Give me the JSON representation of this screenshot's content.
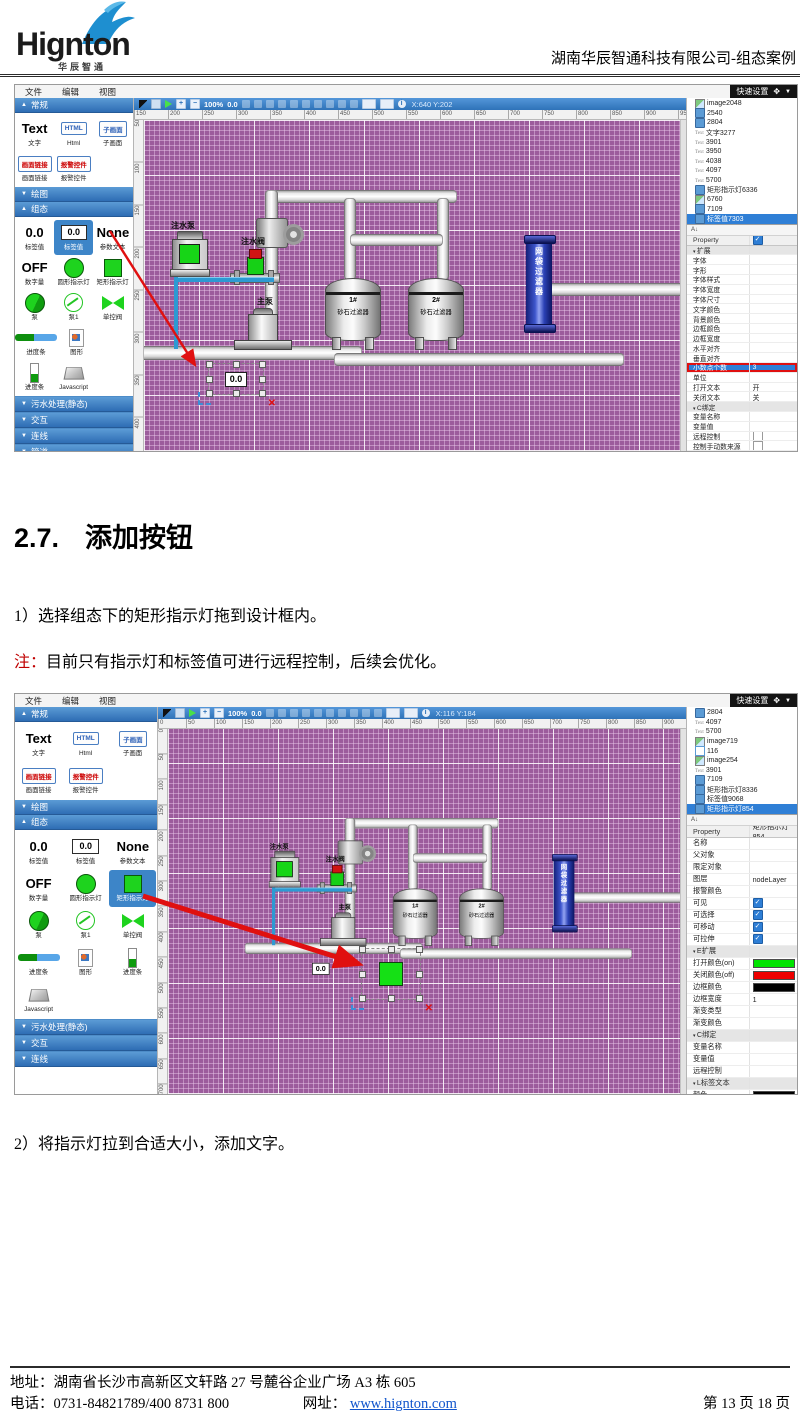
{
  "icons": {
    "move": "✥",
    "caret_down": "▼",
    "close": "✕",
    "sort": "A↓",
    "info": "i",
    "plus": "+",
    "minus": "−"
  },
  "header": {
    "logo_text": "Hignton",
    "logo_sub": "华辰智通",
    "doc_title": "湖南华辰智通科技有限公司-组态案例"
  },
  "doc": {
    "heading_num": "2.7.",
    "heading_text": "添加按钮",
    "step1": "1）选择组态下的矩形指示灯拖到设计框内。",
    "note_label": "注：",
    "note_text": "目前只有指示灯和标签值可进行远程控制，后续会优化。",
    "step2": "2）将指示灯拉到合适大小，添加文字。"
  },
  "footer": {
    "address": "地址：湖南省长沙市高新区文轩路 27 号麓谷企业广场 A3 栋 605",
    "phone": "电话：0731-84821789/400 8731 800",
    "web_label": "网址：",
    "web_url": "www.hignton.com",
    "page_info": "第 13 页 18 页"
  },
  "diagram": {
    "pump1": "注水泵",
    "valve1": "注水阀",
    "pump2": "主泵",
    "tag": "0.0",
    "tank1_no": "1#",
    "tank1_name": "砂石过滤器",
    "tank2_no": "2#",
    "tank2_name": "砂石过滤器",
    "vessel": "网袋过滤器"
  },
  "editor1": {
    "menus": [
      "文件",
      "编辑",
      "视图"
    ],
    "quick_settings": "快速设置",
    "toolbar": {
      "zoom": "100%",
      "angle": "0.0",
      "coords": "X:640 Y:202"
    },
    "sec_common": {
      "label": "常规",
      "arrow": "▲"
    },
    "sec_draw": {
      "label": "绘图",
      "arrow": "▼"
    },
    "sec_zutai": {
      "label": "组态",
      "arrow": "▲"
    },
    "pal_common": [
      {
        "icon": "ic-bigtext",
        "big": "Text",
        "label": "文字"
      },
      {
        "icon": "ic-btn",
        "big": "HTML",
        "label": "Html"
      },
      {
        "icon": "ic-btn",
        "big": "子画面",
        "label": "子画面"
      },
      {
        "icon": "ic-btn red",
        "big": "画面链接",
        "label": "画面链接"
      },
      {
        "icon": "ic-btn red",
        "big": "报警控件",
        "label": "报警控件"
      }
    ],
    "pal_zutai": [
      {
        "icon": "ic-bigtext",
        "big": "0.0",
        "label": "标签值"
      },
      {
        "icon": "ic-box",
        "big": "0.0",
        "label": "标签值",
        "cls": "sel"
      },
      {
        "icon": "ic-bigtext",
        "big": "None",
        "label": "参数文本"
      },
      {
        "icon": "ic-bigtext",
        "big": "OFF",
        "label": "数字量"
      },
      {
        "icon": "ic-circle",
        "label": "圆形指示灯"
      },
      {
        "icon": "ic-square",
        "label": "矩形指示灯"
      },
      {
        "icon": "ic-pie",
        "label": "泵"
      },
      {
        "icon": "ic-ocircle",
        "label": "泵1"
      },
      {
        "icon": "ic-bowtie",
        "label": "单控阀"
      },
      {
        "icon": "ic-hbar",
        "label": "进度条"
      },
      {
        "icon": "ic-file",
        "label": "图形"
      },
      {
        "icon": "ic-vbar",
        "label": "进度条"
      },
      {
        "icon": "ic-js",
        "label": "Javascript"
      }
    ],
    "collapsed": [
      {
        "arrow": "▼",
        "label": "污水处理(静态)"
      },
      {
        "arrow": "▼",
        "label": "交互"
      },
      {
        "arrow": "▼",
        "label": "连线"
      },
      {
        "arrow": "▼",
        "label": "管道"
      },
      {
        "arrow": "▼",
        "label": "共享组件"
      },
      {
        "arrow": "▼",
        "label": "用户图片"
      }
    ],
    "h_ruler": [
      "150",
      "200",
      "250",
      "300",
      "350",
      "400",
      "450",
      "500",
      "550",
      "600",
      "650",
      "700",
      "750",
      "800",
      "850",
      "900",
      "950"
    ],
    "v_ruler": [
      "50",
      "100",
      "150",
      "200",
      "250",
      "300",
      "350",
      "400"
    ],
    "tree": [
      {
        "icon": "ti-img",
        "label": "image2048"
      },
      {
        "icon": "ti-cube",
        "label": "2540"
      },
      {
        "icon": "ti-cube",
        "label": "2804"
      },
      {
        "icon": "ti-text",
        "label": "文字3277"
      },
      {
        "icon": "ti-text",
        "label": "3901"
      },
      {
        "icon": "ti-text",
        "label": "3950"
      },
      {
        "icon": "ti-text",
        "label": "4038"
      },
      {
        "icon": "ti-text",
        "label": "4097"
      },
      {
        "icon": "ti-text",
        "label": "5700"
      },
      {
        "icon": "ti-cube",
        "label": "矩形指示灯6336"
      },
      {
        "icon": "ti-img",
        "label": "6760"
      },
      {
        "icon": "ti-cube",
        "label": "7109"
      },
      {
        "icon": "ti-cube",
        "label": "标签值7303",
        "cls": "sel"
      }
    ],
    "props": [
      {
        "label": "Property",
        "value": "Value",
        "cls": "hdr"
      },
      {
        "label": "可编辑",
        "value": "",
        "cls": "chk-on"
      },
      {
        "label": "扩展",
        "value": "",
        "cls": "sec"
      },
      {
        "label": "字体",
        "value": ""
      },
      {
        "label": "字形",
        "value": ""
      },
      {
        "label": "字体样式",
        "value": ""
      },
      {
        "label": "字体宽度",
        "value": ""
      },
      {
        "label": "字体尺寸",
        "value": ""
      },
      {
        "label": "文字颜色",
        "value": ""
      },
      {
        "label": "背景颜色",
        "value": ""
      },
      {
        "label": "边框颜色",
        "value": ""
      },
      {
        "label": "边框宽度",
        "value": ""
      },
      {
        "label": "水平对齐",
        "value": ""
      },
      {
        "label": "垂直对齐",
        "value": ""
      },
      {
        "label": "小数点个数",
        "value": "3",
        "cls": "hl redbox"
      },
      {
        "label": "单位",
        "value": ""
      },
      {
        "label": "打开文本",
        "value": "开"
      },
      {
        "label": "关闭文本",
        "value": "关"
      },
      {
        "label": "C绑定",
        "value": "",
        "cls": "sec"
      },
      {
        "label": "变量名称",
        "value": ""
      },
      {
        "label": "变量值",
        "value": ""
      },
      {
        "label": "远程控制",
        "value": "",
        "cls": "chk-off"
      },
      {
        "label": "控制手动数来源",
        "value": "",
        "cls": "chk-off"
      },
      {
        "label": "L标签文本",
        "value": "",
        "cls": "sec"
      },
      {
        "label": "颜色",
        "value": "",
        "cls": "swatch",
        "color": "#000000"
      },
      {
        "label": "背景",
        "value": ""
      }
    ]
  },
  "editor2": {
    "menus": [
      "文件",
      "编辑",
      "视图"
    ],
    "quick_settings": "快速设置",
    "toolbar": {
      "zoom": "100%",
      "angle": "0.0",
      "coords": "X:116 Y:184"
    },
    "sec_common": {
      "label": "常规",
      "arrow": "▲"
    },
    "sec_draw": {
      "label": "绘图",
      "arrow": "▼"
    },
    "sec_zutai": {
      "label": "组态",
      "arrow": "▲"
    },
    "pal_common": [
      {
        "icon": "ic-bigtext",
        "big": "Text",
        "label": "文字"
      },
      {
        "icon": "ic-btn",
        "big": "HTML",
        "label": "Html"
      },
      {
        "icon": "ic-btn",
        "big": "子画面",
        "label": "子画面"
      },
      {
        "icon": "ic-btn red",
        "big": "画面链接",
        "label": "画面链接"
      },
      {
        "icon": "ic-btn red",
        "big": "报警控件",
        "label": "报警控件"
      }
    ],
    "pal_zutai": [
      {
        "icon": "ic-bigtext",
        "big": "0.0",
        "label": "标签值"
      },
      {
        "icon": "ic-box",
        "big": "0.0",
        "label": "标签值"
      },
      {
        "icon": "ic-bigtext",
        "big": "None",
        "label": "参数文本"
      },
      {
        "icon": "ic-bigtext",
        "big": "OFF",
        "label": "数字量"
      },
      {
        "icon": "ic-circle",
        "label": "圆形指示灯"
      },
      {
        "icon": "ic-square",
        "label": "矩形指示灯",
        "cls": "sel"
      },
      {
        "icon": "ic-pie",
        "label": "泵"
      },
      {
        "icon": "ic-ocircle",
        "label": "泵1"
      },
      {
        "icon": "ic-bowtie",
        "label": "单控阀"
      },
      {
        "icon": "ic-hbar",
        "label": "进度条"
      },
      {
        "icon": "ic-file",
        "label": "图形"
      },
      {
        "icon": "ic-vbar",
        "label": "进度条"
      },
      {
        "icon": "ic-js",
        "label": "Javascript"
      }
    ],
    "collapsed": [
      {
        "arrow": "▼",
        "label": "污水处理(静态)"
      },
      {
        "arrow": "▼",
        "label": "交互"
      },
      {
        "arrow": "▼",
        "label": "连线"
      }
    ],
    "h_ruler": [
      "0",
      "50",
      "100",
      "150",
      "200",
      "250",
      "300",
      "350",
      "400",
      "450",
      "500",
      "550",
      "600",
      "650",
      "700",
      "750",
      "800",
      "850",
      "900",
      "950"
    ],
    "v_ruler": [
      "0",
      "50",
      "100",
      "150",
      "200",
      "250",
      "300",
      "350",
      "400",
      "450",
      "500",
      "550",
      "600",
      "650",
      "700"
    ],
    "tree": [
      {
        "icon": "ti-cube",
        "label": "2804"
      },
      {
        "icon": "ti-text",
        "label": "4097"
      },
      {
        "icon": "ti-text",
        "label": "5700"
      },
      {
        "icon": "ti-img",
        "label": "image719"
      },
      {
        "icon": "ti-page",
        "label": "116"
      },
      {
        "icon": "ti-img",
        "label": "image254"
      },
      {
        "icon": "ti-text",
        "label": "3901"
      },
      {
        "icon": "ti-cube",
        "label": "7109"
      },
      {
        "icon": "ti-cube",
        "label": "矩形指示灯8336"
      },
      {
        "icon": "ti-cube",
        "label": "标签值9068"
      },
      {
        "icon": "ti-cube",
        "label": "矩形指示灯854",
        "cls": "sel"
      }
    ],
    "props": [
      {
        "label": "Property",
        "value": "Value",
        "cls": "hdr"
      },
      {
        "label": "标识",
        "value": "矩形指示灯854"
      },
      {
        "label": "名称",
        "value": ""
      },
      {
        "label": "父对象",
        "value": ""
      },
      {
        "label": "限定对象",
        "value": ""
      },
      {
        "label": "图层",
        "value": "nodeLayer"
      },
      {
        "label": "报警颜色",
        "value": ""
      },
      {
        "label": "可见",
        "value": "",
        "cls": "chk-on"
      },
      {
        "label": "可选择",
        "value": "",
        "cls": "chk-on"
      },
      {
        "label": "可移动",
        "value": "",
        "cls": "chk-on"
      },
      {
        "label": "可拉伸",
        "value": "",
        "cls": "chk-on"
      },
      {
        "label": "E扩展",
        "value": "",
        "cls": "sec"
      },
      {
        "label": "打开颜色(on)",
        "value": "",
        "cls": "swatch",
        "color": "#00e400"
      },
      {
        "label": "关闭颜色(off)",
        "value": "",
        "cls": "swatch",
        "color": "#ee0000"
      },
      {
        "label": "边框颜色",
        "value": "",
        "cls": "swatch",
        "color": "#000000"
      },
      {
        "label": "边框宽度",
        "value": "1"
      },
      {
        "label": "渐变类型",
        "value": ""
      },
      {
        "label": "渐变颜色",
        "value": ""
      },
      {
        "label": "C绑定",
        "value": "",
        "cls": "sec"
      },
      {
        "label": "变量名称",
        "value": ""
      },
      {
        "label": "变量值",
        "value": ""
      },
      {
        "label": "远程控制",
        "value": ""
      },
      {
        "label": "L标签文本",
        "value": "",
        "cls": "sec"
      },
      {
        "label": "颜色",
        "value": "",
        "cls": "swatch",
        "color": "#000000"
      }
    ]
  }
}
